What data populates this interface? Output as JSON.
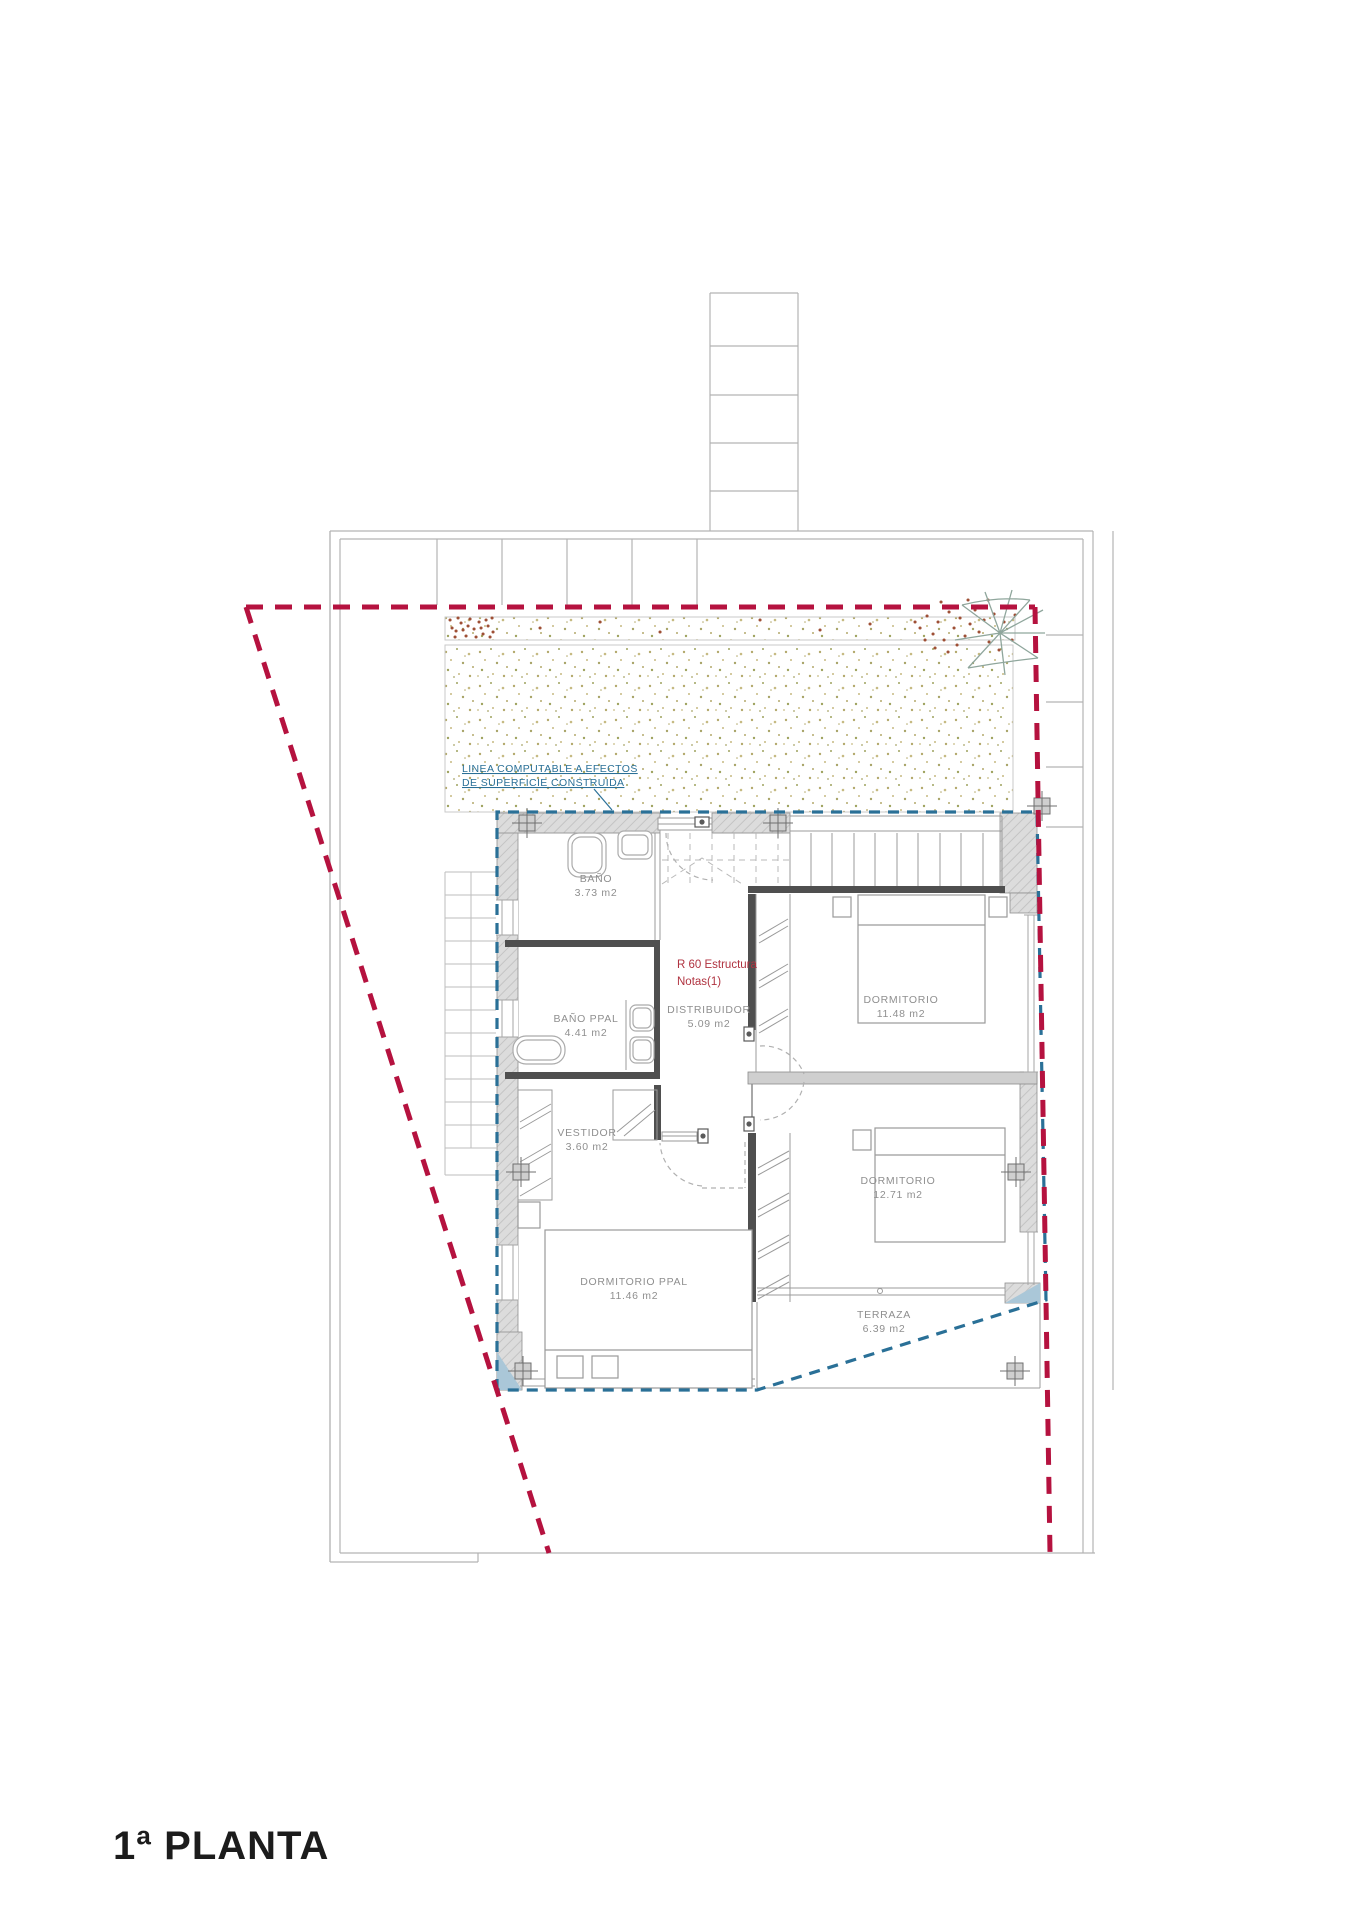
{
  "page": {
    "title": "1ª PLANTA"
  },
  "plan": {
    "computable_note": {
      "line1": "LINEA COMPUTABLE A EFECTOS",
      "line2": "DE SUPERFICIE CONSTRUIDA"
    },
    "structure_note": {
      "line1": "R 60 Estructura",
      "line2": "Notas(1)"
    },
    "rooms": [
      {
        "name": "BAÑO",
        "area": "3.73 m2"
      },
      {
        "name": "BAÑO PPAL",
        "area": "4.41 m2"
      },
      {
        "name": "DISTRIBUIDOR",
        "area": "5.09 m2"
      },
      {
        "name": "DORMITORIO",
        "area": "11.48 m2"
      },
      {
        "name": "VESTIDOR",
        "area": "3.60 m2"
      },
      {
        "name": "DORMITORIO",
        "area": "12.71 m2"
      },
      {
        "name": "DORMITORIO PPAL",
        "area": "11.46 m2"
      },
      {
        "name": "TERRAZA",
        "area": "6.39 m2"
      }
    ],
    "colors": {
      "property_line": "#b5123f",
      "computable_line": "#2a7097",
      "note_text": "#b03340",
      "label_text": "#8f8f8f",
      "title_text": "#1c1c1c"
    }
  }
}
